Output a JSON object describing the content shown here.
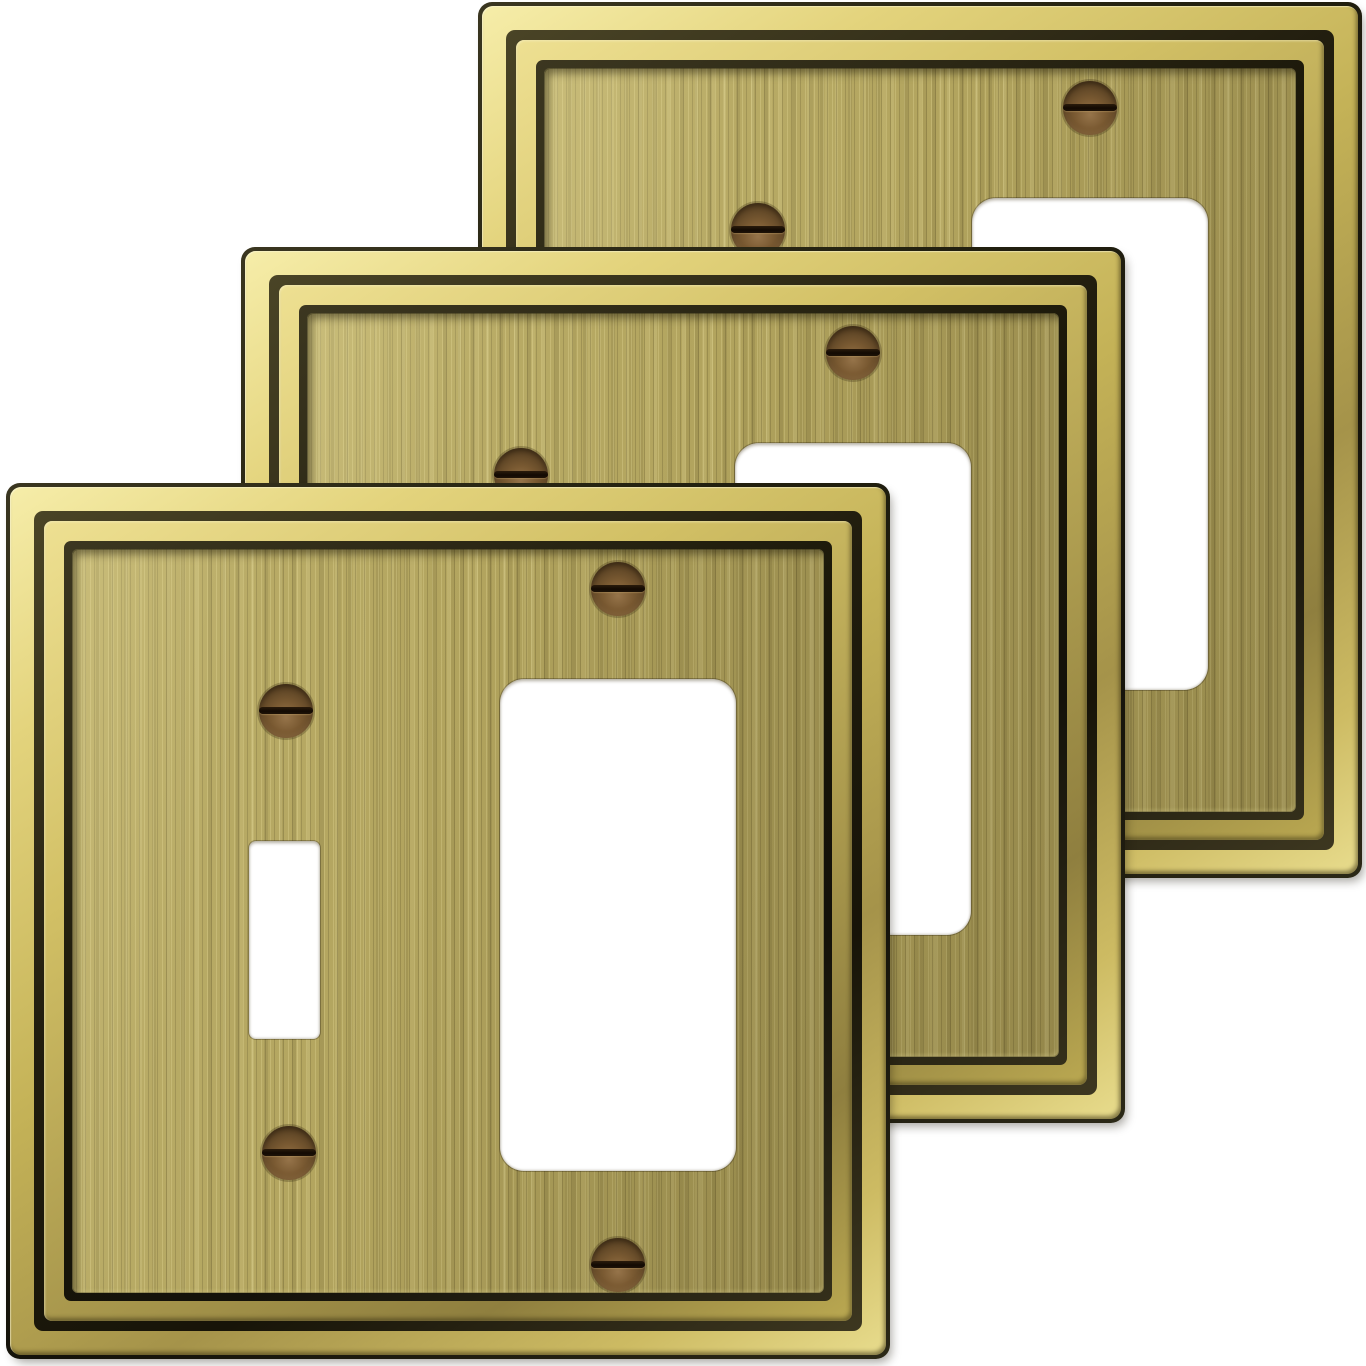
{
  "meta": {
    "description": "Product photo: three identical antique brass two-gang wall plates (one toggle-switch cutout and one rocker cutout each), stacked diagonally from back top-right to front bottom-left on a plain white background",
    "item_count": 3
  },
  "background_color": "#ffffff",
  "palette": {
    "gold_highlight": "#f3e9a2",
    "gold_mid": "#d6c468",
    "gold_deep": "#a2914a",
    "groove_dark": "#1d1a0e",
    "edge_outline": "#22200f",
    "face_base": "#b2a45e",
    "face_light_streak": "#dccf87",
    "face_dark_streak": "#75693a",
    "screw_bronze": "#6e5230",
    "screw_highlight": "#96744a",
    "screw_slot": "#1a1005",
    "cutout_white": "#ffffff"
  },
  "plate_template": {
    "width": 884,
    "height": 876,
    "corner_radius": 14,
    "layers": [
      {
        "name": "gold-band-outer",
        "inset": 4,
        "radius": 11
      },
      {
        "name": "groove-outer",
        "inset": 28,
        "radius": 9
      },
      {
        "name": "gold-band-inner",
        "inset": 38,
        "radius": 8
      },
      {
        "name": "groove-inner",
        "inset": 58,
        "radius": 7
      },
      {
        "name": "face",
        "inset": 66,
        "radius": 6
      }
    ],
    "toggle_cutout": {
      "x": 243,
      "y": 358,
      "width": 71,
      "height": 198,
      "radius": 7
    },
    "rocker_cutout": {
      "x": 494,
      "y": 196,
      "width": 236,
      "height": 492,
      "radius": 24
    },
    "screws": [
      {
        "name": "toggle-top",
        "cx": 280,
        "cy": 228
      },
      {
        "name": "toggle-bottom",
        "cx": 283,
        "cy": 670
      },
      {
        "name": "rocker-top",
        "cx": 612,
        "cy": 106
      },
      {
        "name": "rocker-bottom",
        "cx": 612,
        "cy": 782
      }
    ],
    "screw_diameter": 54
  },
  "plates": [
    {
      "id": "back",
      "x": 478,
      "y": 2,
      "z": 1
    },
    {
      "id": "middle",
      "x": 241,
      "y": 247,
      "z": 2
    },
    {
      "id": "front",
      "x": 6,
      "y": 483,
      "z": 3
    }
  ]
}
